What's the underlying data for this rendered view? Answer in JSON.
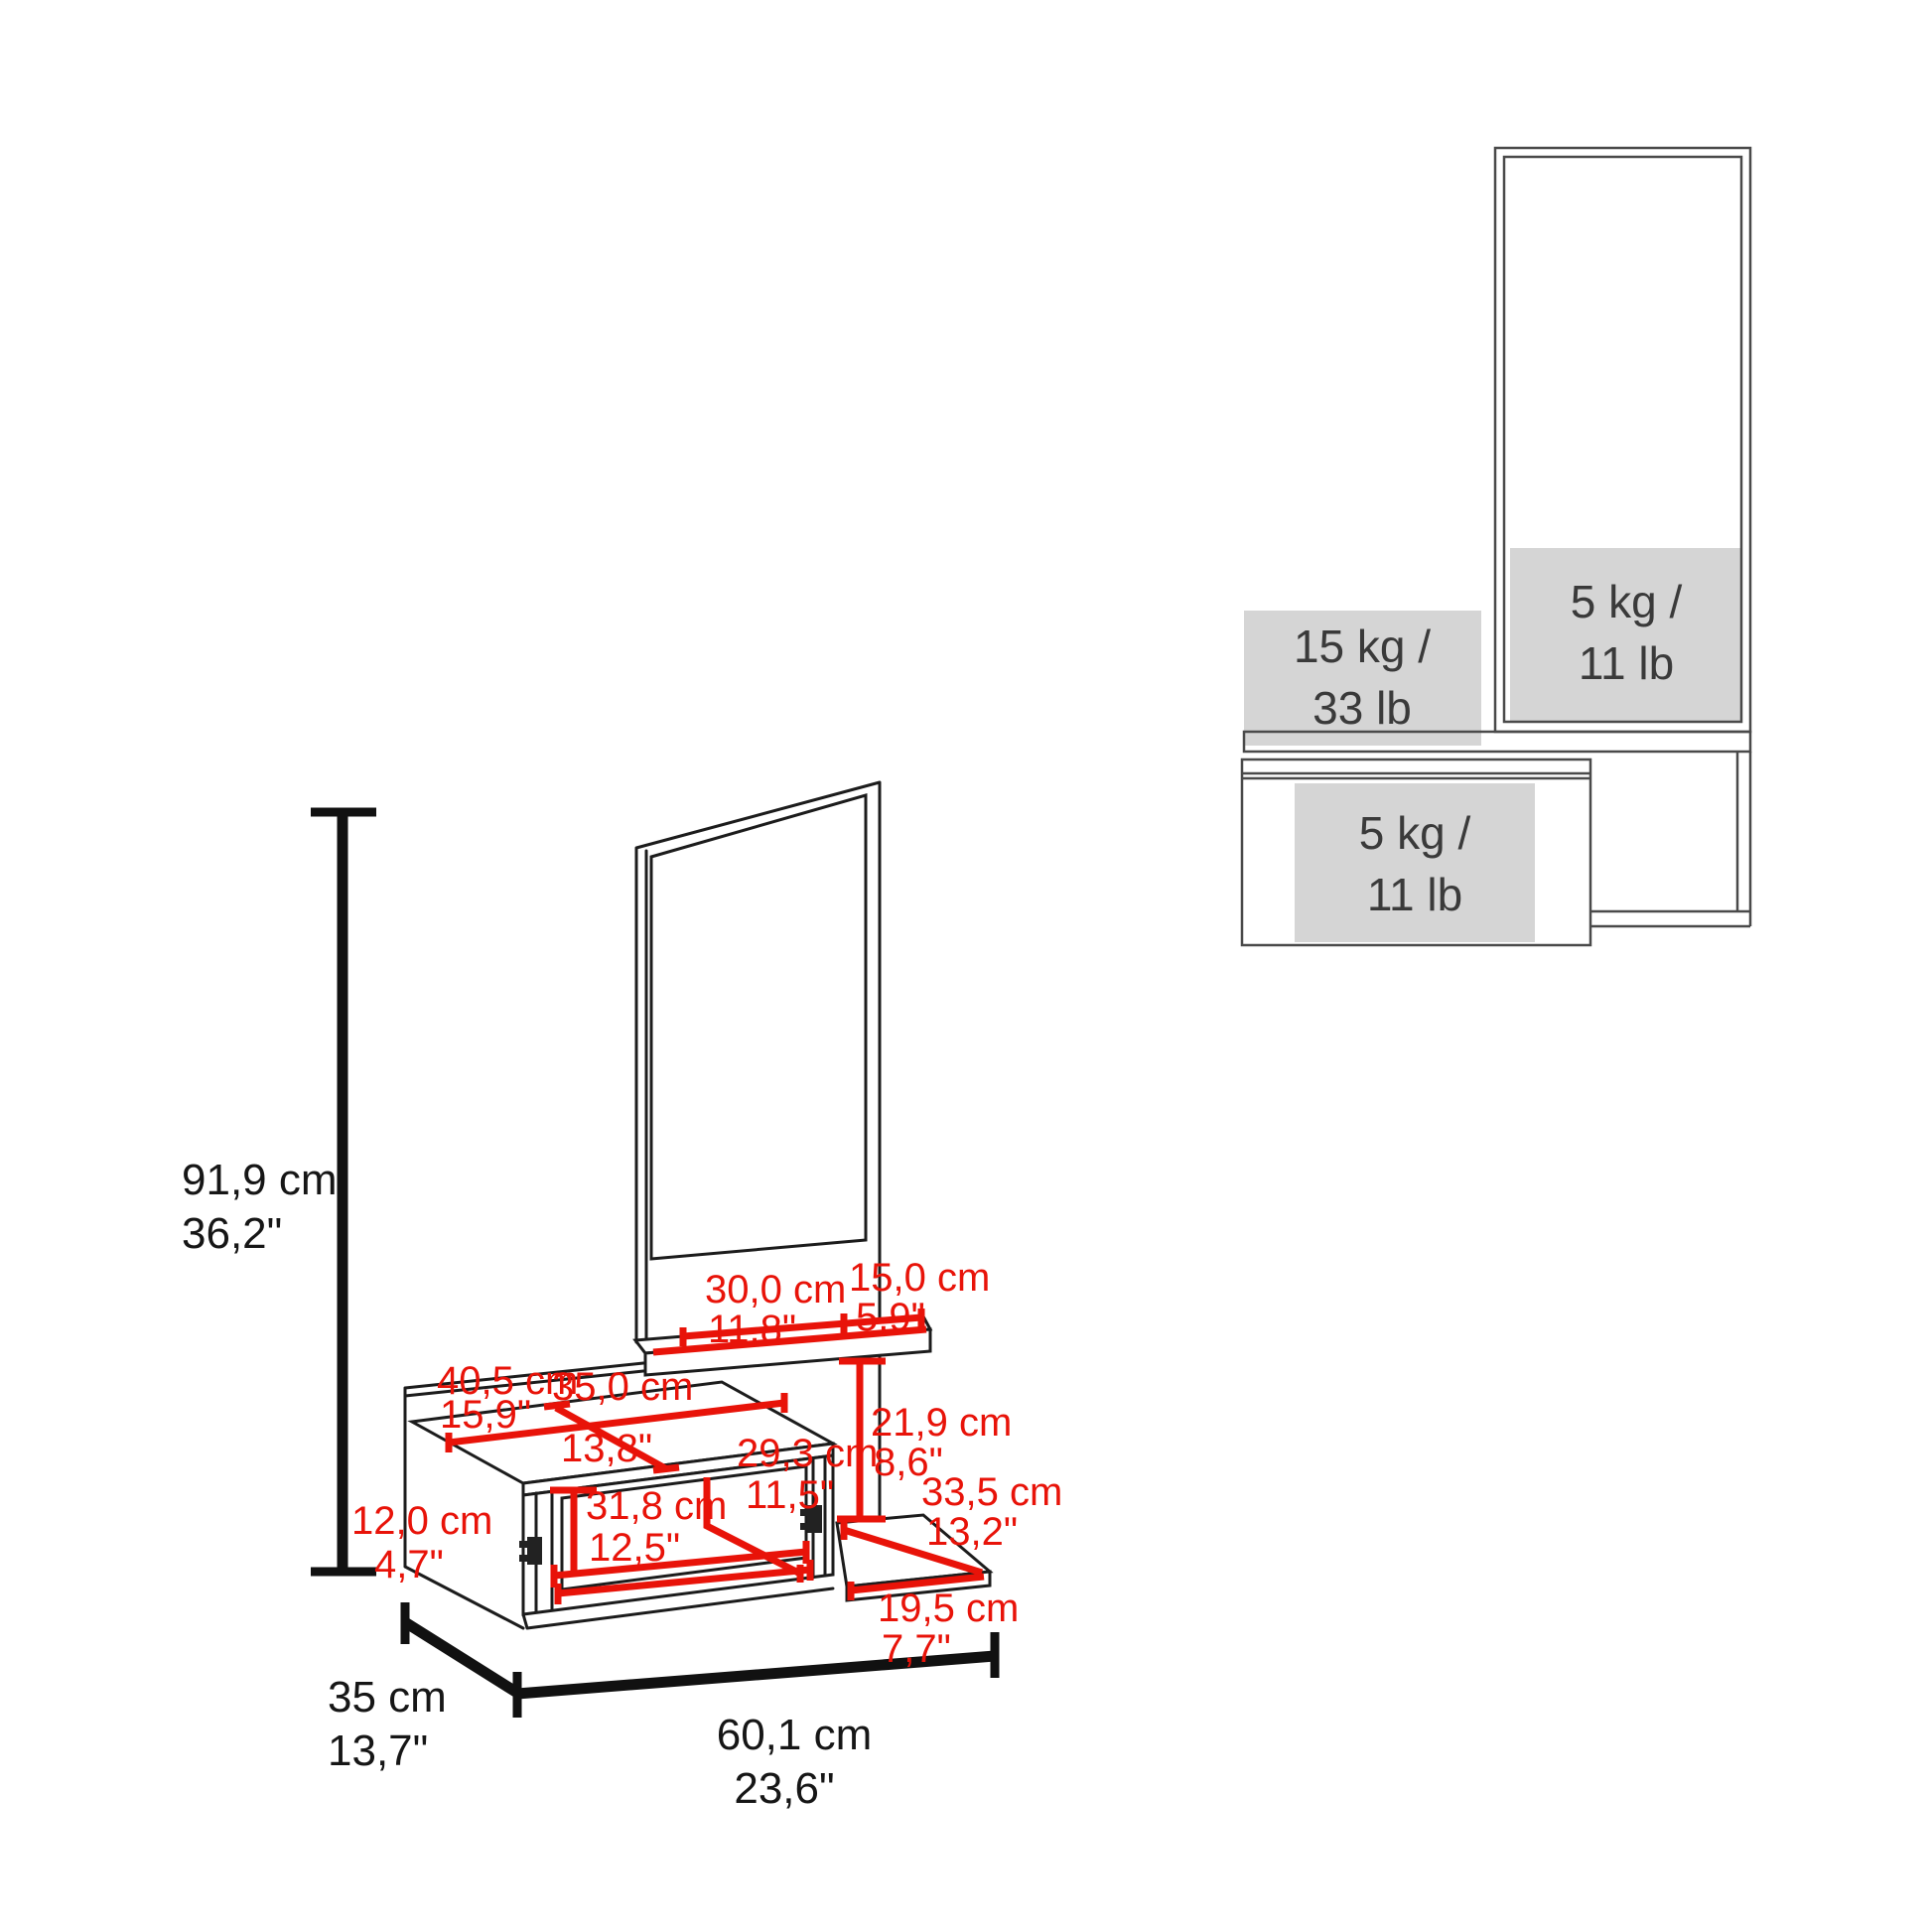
{
  "colors": {
    "dimension_red": "#e81309",
    "line_black": "#1c1c1c",
    "dim_text_black": "#161616",
    "capacity_gray_fill": "#d5d5d5",
    "capacity_line_gray": "#4a4a4a",
    "capacity_text": "#3a3a3a"
  },
  "main_view": {
    "height": {
      "cm": "91,9 cm",
      "inch": "36,2\""
    },
    "depth": {
      "cm": "35 cm",
      "inch": "13,7\""
    },
    "width": {
      "cm": "60,1 cm",
      "inch": "23,6\""
    },
    "dims": {
      "d30": {
        "cm": "30,0 cm",
        "inch": "11,8\""
      },
      "d15": {
        "cm": "15,0 cm",
        "inch": "5,9\""
      },
      "d40_5": {
        "cm": "40,5 cm",
        "inch": "15,9\""
      },
      "d35": {
        "cm": "35,0 cm",
        "inch": "13,8\""
      },
      "d29_3": {
        "cm": "29,3 cm",
        "inch": "11,5\""
      },
      "d21_9": {
        "cm": "21,9 cm",
        "inch": "8,6\""
      },
      "d33_5": {
        "cm": "33,5 cm",
        "inch": "13,2\""
      },
      "d12": {
        "cm": "12,0 cm",
        "inch": "4,7\""
      },
      "d31_8": {
        "cm": "31,8 cm",
        "inch": "12,5\""
      },
      "d19_5": {
        "cm": "19,5 cm",
        "inch": "7,7\""
      }
    }
  },
  "load_view": {
    "mirror_shelf": {
      "line1": "5 kg /",
      "line2": "11 lb"
    },
    "wall_shelf": {
      "line1": "15 kg /",
      "line2": "33 lb"
    },
    "cabinet": {
      "line1": "5 kg /",
      "line2": "11 lb"
    }
  }
}
